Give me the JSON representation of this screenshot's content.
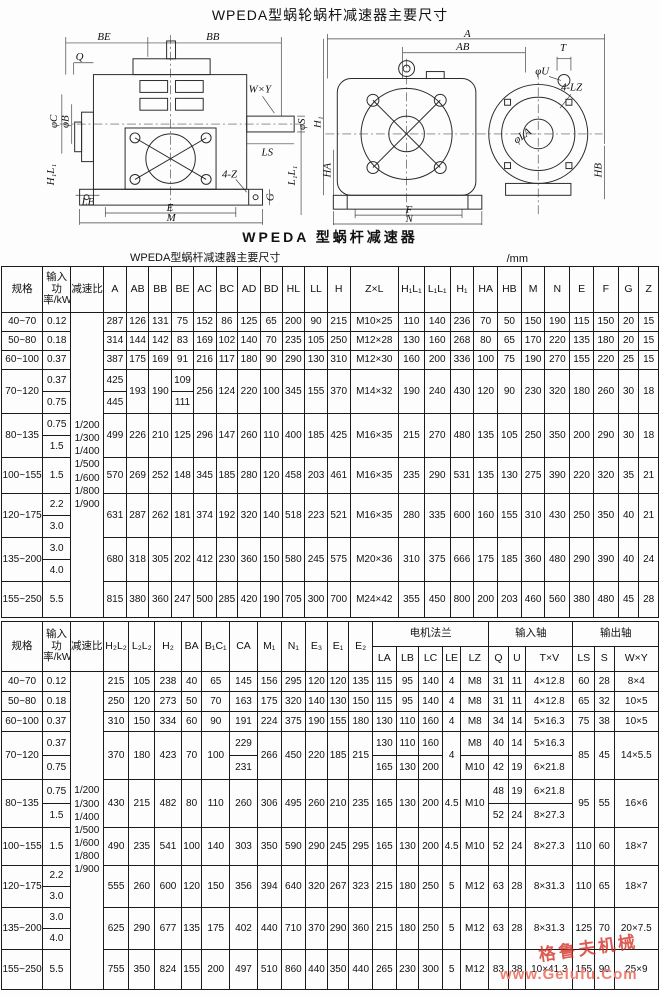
{
  "page_title": "WPEDA型蜗轮蜗杆减速器主要尺寸",
  "figure": {
    "caption": "WPEDA 型蜗杆减速器",
    "labels": {
      "be": "BE",
      "bb": "BB",
      "q": "Q",
      "wxy": "W×Y",
      "phi_c": "φC",
      "phi_b": "φB",
      "phi_s": "φS",
      "ls": "LS",
      "le": "LE",
      "four_z": "4-Z",
      "g": "G",
      "e": "E",
      "m": "M",
      "l1l1": "L₁L₁",
      "h1l1": "H₁L₁",
      "a": "A",
      "ab": "AB",
      "t": "T",
      "phi_u": "φU",
      "four_lz": "4-LZ",
      "phi_la": "φLA",
      "h1": "H₁",
      "ha": "HA",
      "hb": "HB",
      "f": "F",
      "n": "N"
    }
  },
  "table_note": {
    "title": "WPEDA型蜗杆减速器主要尺寸",
    "unit": "/mm"
  },
  "table1": {
    "col_headers": [
      "规格",
      "输入功率/kW",
      "减速比",
      "A",
      "AB",
      "BB",
      "BE",
      "AC",
      "BC",
      "AD",
      "BD",
      "HL",
      "LL",
      "H",
      "Z×L",
      "H₁L₁",
      "L₁L₁",
      "H₁",
      "HA",
      "HB",
      "M",
      "N",
      "E",
      "F",
      "G",
      "Z"
    ],
    "ratios": [
      "1/200",
      "1/300",
      "1/400",
      "1/500",
      "1/600",
      "1/800",
      "1/900"
    ],
    "rows": [
      {
        "spec": "40~70",
        "power": "0.12",
        "cells": [
          "287",
          "126",
          "131",
          "75",
          "152",
          "86",
          "125",
          "65",
          "200",
          "90",
          "215",
          "M10×25",
          "110",
          "140",
          "236",
          "70",
          "50",
          "150",
          "190",
          "115",
          "150",
          "20",
          "15"
        ]
      },
      {
        "spec": "50~80",
        "power": "0.18",
        "cells": [
          "314",
          "144",
          "142",
          "83",
          "169",
          "102",
          "140",
          "70",
          "235",
          "105",
          "250",
          "M12×28",
          "130",
          "160",
          "268",
          "80",
          "65",
          "170",
          "220",
          "135",
          "180",
          "20",
          "15"
        ]
      },
      {
        "spec": "60~100",
        "power": "0.37",
        "cells": [
          "387",
          "175",
          "169",
          "91",
          "216",
          "117",
          "180",
          "90",
          "290",
          "130",
          "310",
          "M12×30",
          "160",
          "200",
          "336",
          "100",
          "75",
          "190",
          "270",
          "155",
          "220",
          "25",
          "15"
        ]
      },
      {
        "spec": "70~120",
        "power": "0.37|0.75",
        "cells": [
          "425|445",
          "193",
          "190",
          "109|111",
          "256",
          "124",
          "220",
          "100",
          "345",
          "155",
          "370",
          "M14×32",
          "190",
          "240",
          "430",
          "120",
          "90",
          "230",
          "320",
          "180",
          "260",
          "30",
          "18"
        ]
      },
      {
        "spec": "80~135",
        "power": "0.75|1.5",
        "cells": [
          "499",
          "226",
          "210",
          "125",
          "296",
          "147",
          "260",
          "110",
          "400",
          "185",
          "425",
          "M16×35",
          "215",
          "270",
          "480",
          "135",
          "105",
          "250",
          "350",
          "200",
          "290",
          "30",
          "18"
        ]
      },
      {
        "spec": "100~155",
        "power": "1.5",
        "cells": [
          "570",
          "269",
          "252",
          "148",
          "345",
          "185",
          "280",
          "120",
          "458",
          "203",
          "461",
          "M16×35",
          "235",
          "290",
          "531",
          "135",
          "130",
          "275",
          "390",
          "220",
          "320",
          "35",
          "21"
        ]
      },
      {
        "spec": "120~175",
        "power": "2.2|3.0",
        "cells": [
          "631",
          "287",
          "262",
          "181",
          "374",
          "192",
          "320",
          "140",
          "518",
          "223",
          "521",
          "M16×35",
          "280",
          "335",
          "600",
          "160",
          "155",
          "310",
          "430",
          "250",
          "350",
          "40",
          "21"
        ]
      },
      {
        "spec": "135~200",
        "power": "3.0|4.0",
        "cells": [
          "680",
          "318",
          "305",
          "202",
          "412",
          "230",
          "360",
          "150",
          "580",
          "245",
          "575",
          "M20×36",
          "310",
          "375",
          "666",
          "175",
          "185",
          "360",
          "480",
          "290",
          "390",
          "40",
          "24"
        ]
      },
      {
        "spec": "155~250",
        "power": "5.5",
        "cells": [
          "815",
          "380",
          "360",
          "247",
          "500",
          "285",
          "420",
          "190",
          "705",
          "300",
          "700",
          "M24×42",
          "355",
          "450",
          "800",
          "200",
          "203",
          "460",
          "560",
          "380",
          "480",
          "45",
          "28"
        ]
      }
    ]
  },
  "table2": {
    "groups": {
      "motor_flange": "电机法兰",
      "input_shaft": "输入轴",
      "output_shaft": "输出轴"
    },
    "col_headers_main": [
      "规格",
      "输入功率/kW",
      "减速比",
      "H₂L₂",
      "L₂L₂",
      "H₂",
      "BA",
      "B₁C₁",
      "CA",
      "M₁",
      "N₁",
      "E₃",
      "E₁",
      "E₂"
    ],
    "col_headers_sub": [
      "LA",
      "LB",
      "LC",
      "LE",
      "LZ",
      "Q",
      "U",
      "T×V",
      "LS",
      "S",
      "W×Y"
    ],
    "ratios": [
      "1/200",
      "1/300",
      "1/400",
      "1/500",
      "1/600",
      "1/800",
      "1/900"
    ],
    "rows": [
      {
        "spec": "40~70",
        "power": "0.12",
        "cells": [
          "215",
          "105",
          "238",
          "40",
          "65",
          "145",
          "156",
          "295",
          "120",
          "120",
          "135",
          "115",
          "95",
          "140",
          "4",
          "M8",
          "31",
          "11",
          "4×12.8",
          "60",
          "28",
          "8×4"
        ]
      },
      {
        "spec": "50~80",
        "power": "0.18",
        "cells": [
          "250",
          "120",
          "273",
          "50",
          "70",
          "163",
          "175",
          "320",
          "140",
          "130",
          "150",
          "115",
          "95",
          "140",
          "4",
          "M8",
          "31",
          "11",
          "4×12.8",
          "65",
          "32",
          "10×5"
        ]
      },
      {
        "spec": "60~100",
        "power": "0.37",
        "cells": [
          "310",
          "150",
          "334",
          "60",
          "90",
          "191",
          "224",
          "375",
          "190",
          "155",
          "180",
          "130",
          "110",
          "160",
          "4",
          "M8",
          "34",
          "14",
          "5×16.3",
          "75",
          "38",
          "10×5"
        ]
      },
      {
        "spec": "70~120",
        "power": "0.37|0.75",
        "cells": [
          "370",
          "180",
          "423",
          "70",
          "100",
          "229|231",
          "266",
          "450",
          "220",
          "185",
          "215",
          "130|165",
          "110|130",
          "160|200",
          "4",
          "M8|M10",
          "40|42",
          "14|19",
          "5×16.3|6×21.8",
          "85",
          "45",
          "14×5.5"
        ]
      },
      {
        "spec": "80~135",
        "power": "0.75|1.5",
        "cells": [
          "430",
          "215",
          "482",
          "80",
          "110",
          "260",
          "306",
          "495",
          "260",
          "210",
          "235",
          "165",
          "130",
          "200",
          "4.5",
          "M10",
          "48|52",
          "19|24",
          "6×21.8|8×27.3",
          "95",
          "55",
          "16×6"
        ]
      },
      {
        "spec": "100~155",
        "power": "1.5",
        "cells": [
          "490",
          "235",
          "541",
          "100",
          "140",
          "303",
          "350",
          "590",
          "290",
          "245",
          "295",
          "165",
          "130",
          "200",
          "4.5",
          "M10",
          "52",
          "24",
          "8×27.3",
          "110",
          "60",
          "18×7"
        ]
      },
      {
        "spec": "120~175",
        "power": "2.2|3.0",
        "cells": [
          "555",
          "260",
          "600",
          "120",
          "150",
          "356",
          "394",
          "640",
          "320",
          "267",
          "323",
          "215",
          "180",
          "250",
          "5",
          "M12",
          "63",
          "28",
          "8×31.3",
          "110",
          "65",
          "18×7"
        ]
      },
      {
        "spec": "135~200",
        "power": "3.0|4.0",
        "cells": [
          "625",
          "290",
          "677",
          "135",
          "175",
          "402",
          "440",
          "710",
          "370",
          "290",
          "360",
          "215",
          "180",
          "250",
          "5",
          "M12",
          "63",
          "28",
          "8×31.3",
          "125",
          "70",
          "20×7.5"
        ]
      },
      {
        "spec": "155~250",
        "power": "5.5",
        "cells": [
          "755",
          "350",
          "824",
          "155",
          "200",
          "497",
          "510",
          "860",
          "440",
          "350",
          "440",
          "265",
          "230",
          "300",
          "5",
          "M12",
          "83",
          "38",
          "10×41.3",
          "155",
          "90",
          "25×9"
        ]
      }
    ]
  },
  "watermark": {
    "stamp": "格鲁夫机械",
    "url": "www.Gelufu.Com"
  }
}
